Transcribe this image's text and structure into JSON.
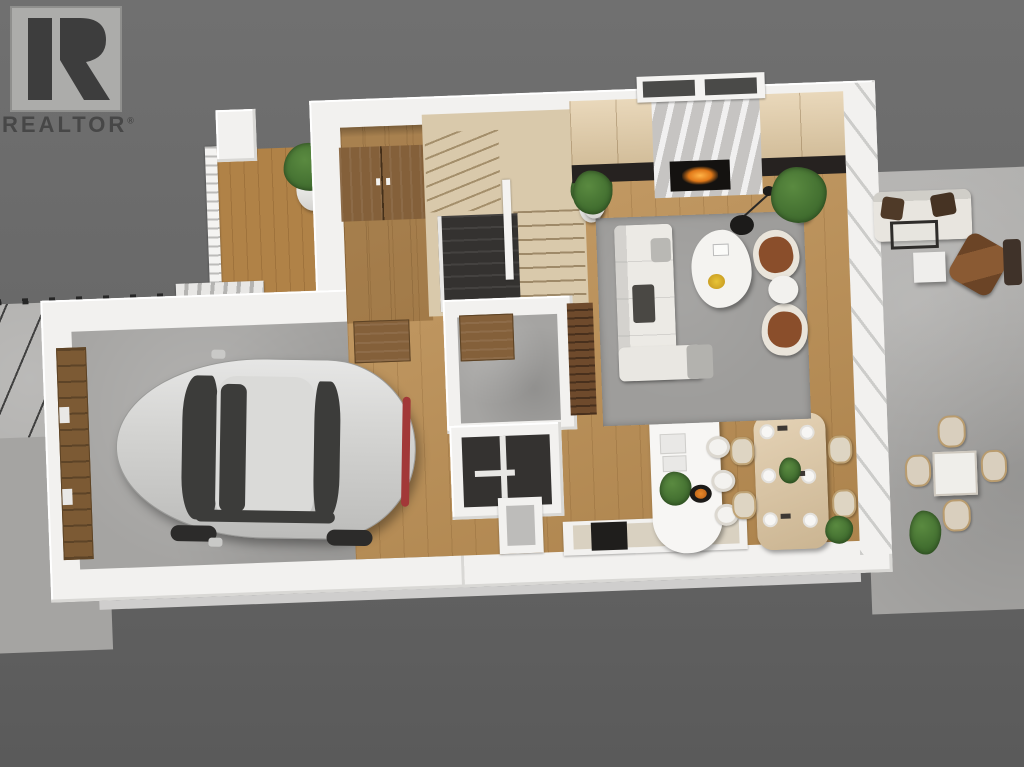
{
  "branding": {
    "logo_text": "REALTOR",
    "registered_mark": "®"
  },
  "palette": {
    "bg_top": "#707070",
    "bg_bottom": "#5a5a5a",
    "wall": "#f2f1ef",
    "wall_shade": "#d9d8d5",
    "concrete": "#b3b2b0",
    "concrete_dark": "#a5a4a2",
    "wood": "#c09255",
    "wood_dark": "#a87c44",
    "wood_light": "#d9c9ab",
    "porch_wood": "#b08247",
    "dining_wood": "#dcc49e",
    "fp_wood": "#e2cba4",
    "rug": "#9e9d9b",
    "marble": "#d6d5d3",
    "hearth": "#262220",
    "fire": "#e07818",
    "leather": "#8a4e2b",
    "cream": "#ded5c3",
    "car": "#d4d4d2",
    "plant": "#3f6b2e",
    "void": "#343230",
    "door_wood": "#84603a",
    "island": "#f7f6f4",
    "counter_top": "#d9d1c1",
    "logo_box": "#acacaa",
    "logo_mark": "#3d3d3d",
    "logo_text": "#474747"
  },
  "scene": {
    "type": "3d-floor-plan-render",
    "view": "top-down",
    "rooms": [
      "front-porch",
      "foyer",
      "staircase",
      "closet",
      "mudroom",
      "powder-room",
      "garage",
      "living-room",
      "kitchen",
      "dining-area",
      "side-patio"
    ],
    "furniture": [
      "silver-sedan",
      "sectional-sofa",
      "gray-ottoman",
      "coffee-table",
      "accent-chairs",
      "round-side-table",
      "arc-floor-lamp",
      "fireplace",
      "area-rug",
      "kitchen-island",
      "bar-stools",
      "dining-table",
      "dining-chairs",
      "outdoor-sofa",
      "outdoor-coffee-table",
      "outdoor-side-table",
      "outdoor-lounge-chair",
      "outdoor-dining-set",
      "potted-plants",
      "shrub"
    ]
  }
}
